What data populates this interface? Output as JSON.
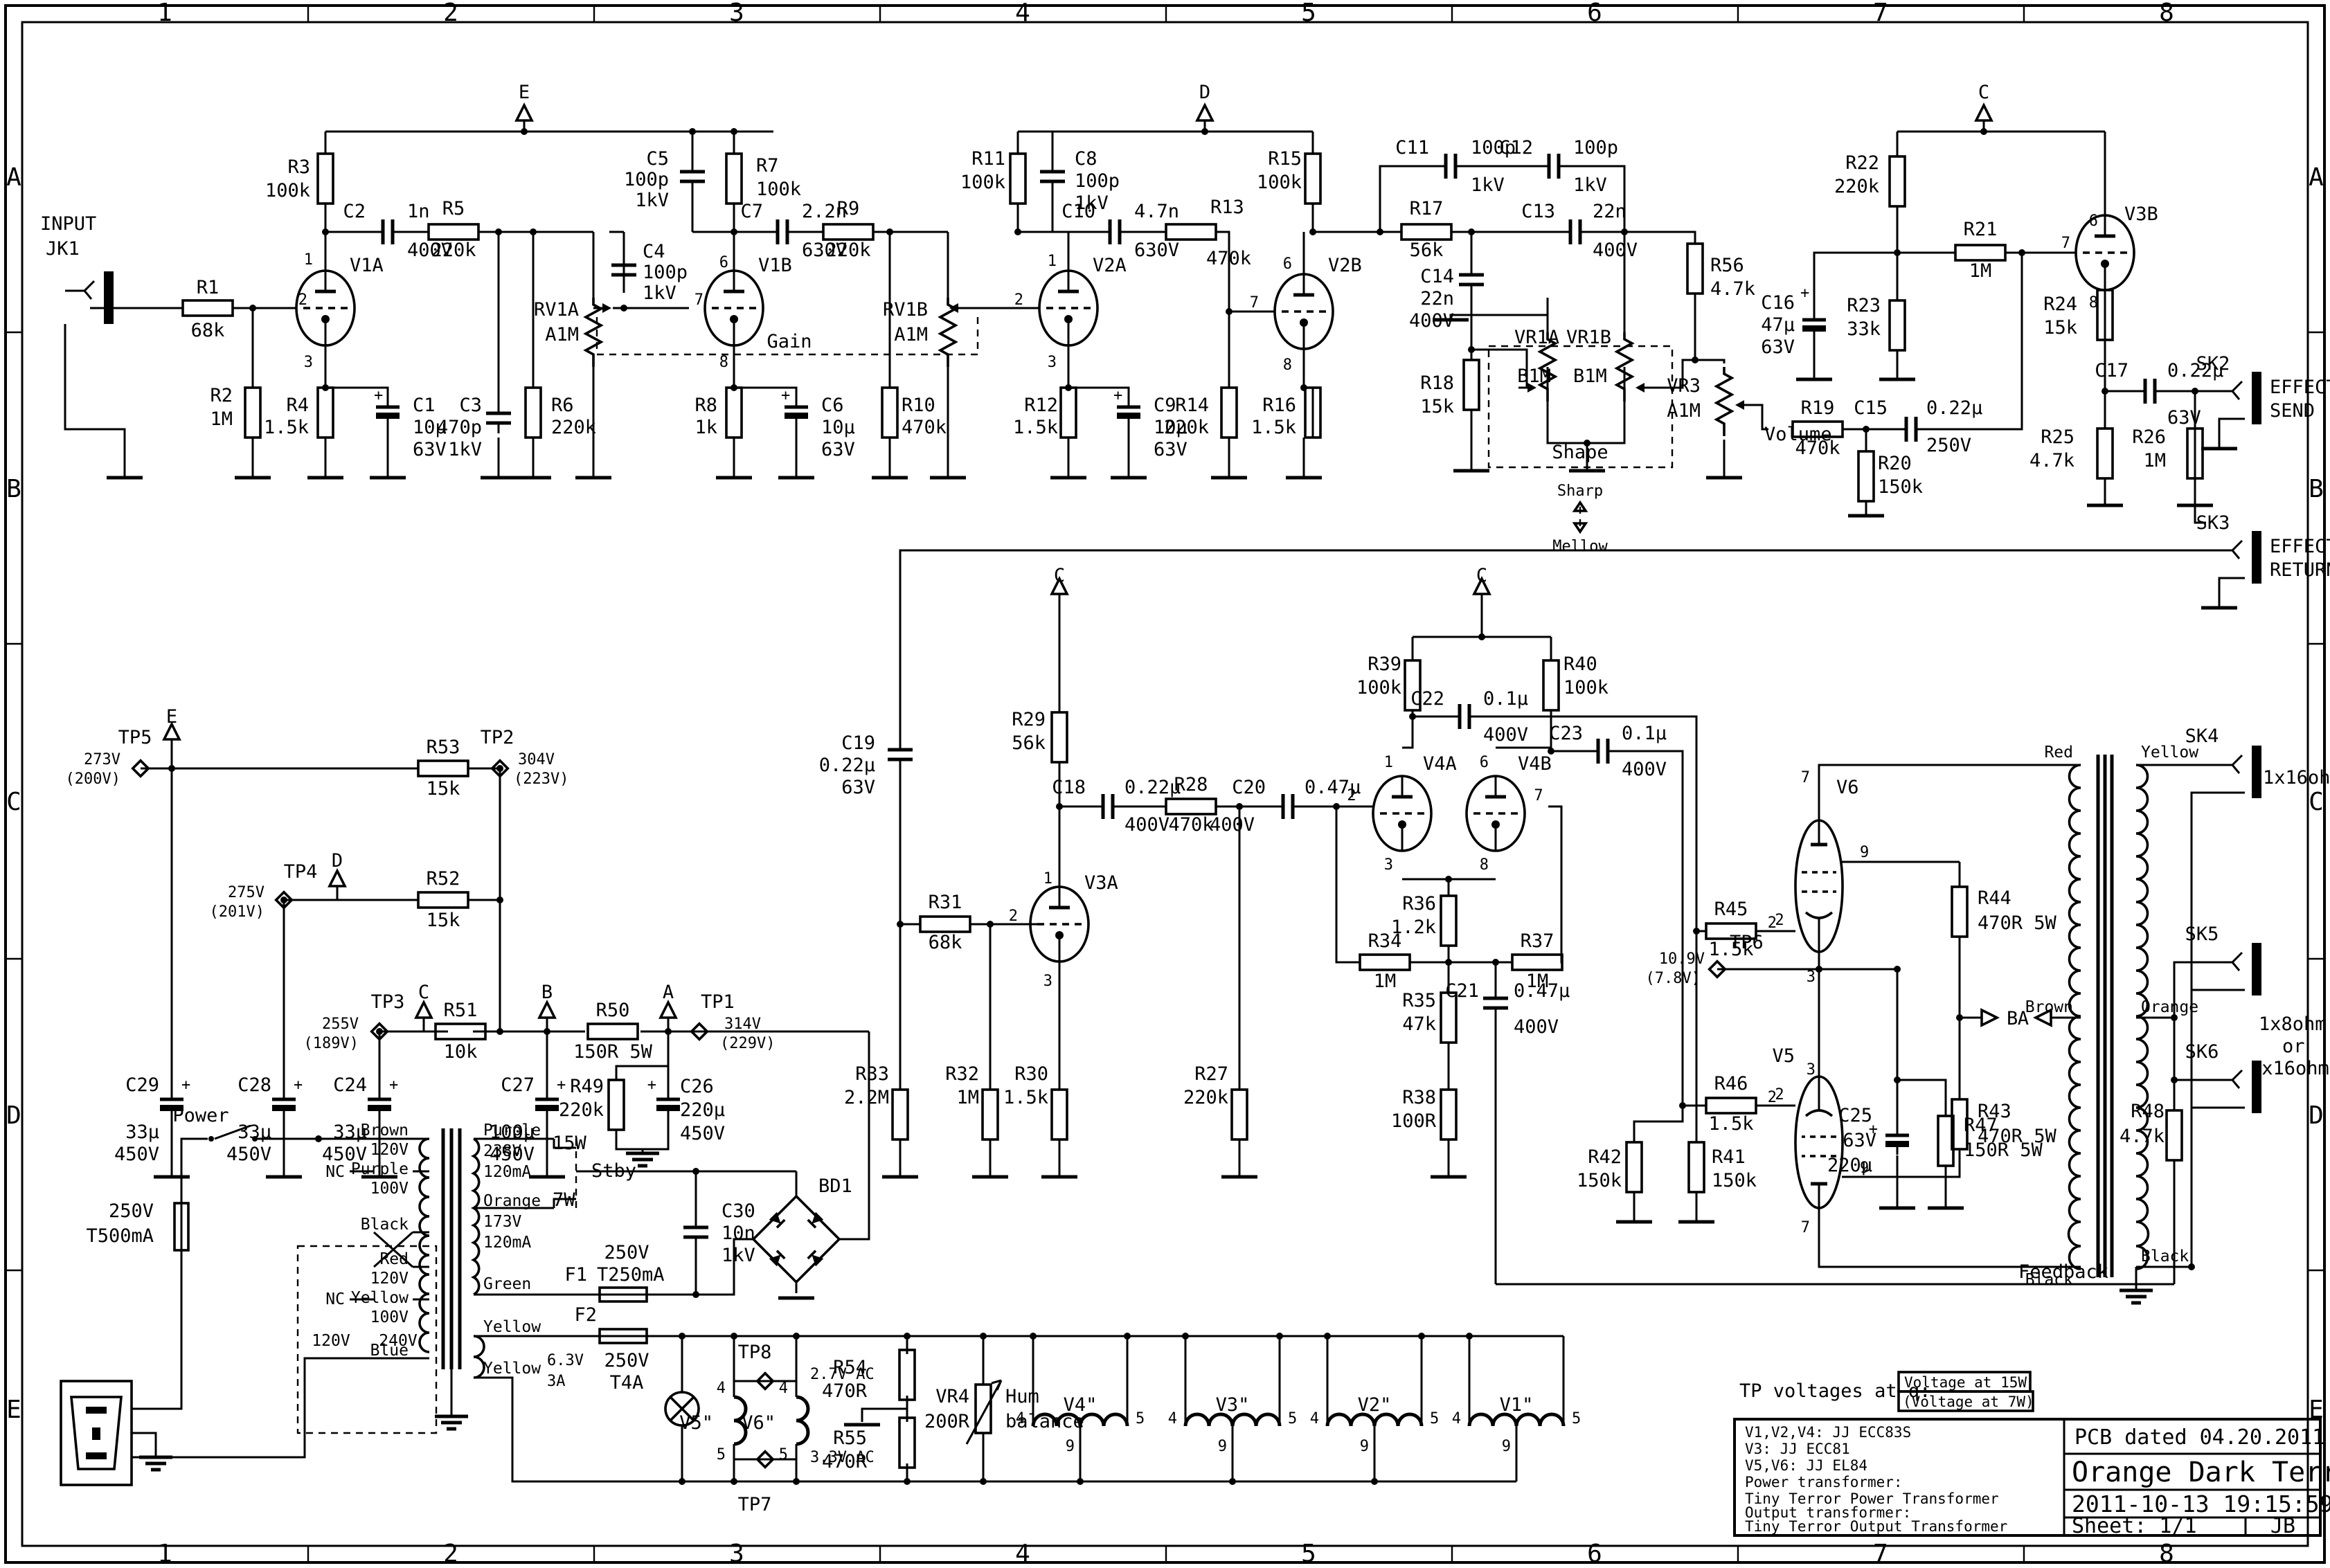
{
  "b": {
    "c": [
      "1",
      "2",
      "3",
      "4",
      "5",
      "6",
      "7",
      "8"
    ],
    "r": [
      "A",
      "B",
      "C",
      "D",
      "E"
    ]
  },
  "t": {
    "in1": "INPUT",
    "in2": "JK1",
    "r1": "R1",
    "r1v": "68k",
    "r2": "R2",
    "r2v": "1M",
    "v1a": "V1A",
    "r3": "R3",
    "r3v": "100k",
    "c2": "C2",
    "c2v": "1n",
    "c2u": "400V",
    "r5": "R5",
    "r5v": "220k",
    "c3": "C3",
    "c3v": "470p",
    "c3u": "1kV",
    "r6": "R6",
    "r6v": "220k",
    "r4": "R4",
    "r4v": "1.5k",
    "c1": "C1",
    "c1v": "10µ",
    "c1u": "63V",
    "e": "E",
    "d": "D",
    "cc": "C",
    "bb": "B",
    "aa": "A",
    "plus": "+",
    "rv1a": "RV1A",
    "rv1av": "A1M",
    "rv1b": "RV1B",
    "rv1bv": "A1M",
    "gain": "Gain",
    "c5": "C5",
    "c5v": "100p",
    "c5u": "1kV",
    "r7": "R7",
    "r7v": "100k",
    "c4": "C4",
    "c4v": "100p",
    "c4u": "1kV",
    "v1b": "V1B",
    "c7": "C7",
    "c7v": "2.2n",
    "c7u": "630V",
    "r9": "R9",
    "r9v": "220k",
    "r8": "R8",
    "r8v": "1k",
    "c6": "C6",
    "c6v": "10µ",
    "c6u": "63V",
    "r10": "R10",
    "r10v": "470k",
    "v2a": "V2A",
    "r11": "R11",
    "r11v": "100k",
    "c8": "C8",
    "c8v": "100p",
    "c8u": "1kV",
    "c10": "C10",
    "c10v": "4.7n",
    "c10u": "630V",
    "r12": "R12",
    "r12v": "1.5k",
    "c9": "C9",
    "c9v": "10µ",
    "c9u": "63V",
    "r13": "R13",
    "r13v": "470k",
    "v2b": "V2B",
    "r14": "R14",
    "r14v": "220k",
    "r15": "R15",
    "r15v": "100k",
    "r16": "R16",
    "r16v": "1.5k",
    "c11": "C11",
    "c11v": "100p",
    "c11u": "1kV",
    "c12": "C12",
    "c12v": "100p",
    "c12u": "1kV",
    "r17": "R17",
    "r17v": "56k",
    "c13": "C13",
    "c13v": "22n",
    "c13u": "400V",
    "c14": "C14",
    "c14v": "22n",
    "c14u": "400V",
    "r18": "R18",
    "r18v": "15k",
    "vr1a": "VR1A",
    "vr1b": "VR1B",
    "b1m": "B1M",
    "b1m2": "B1M",
    "shape": "Shape",
    "sharp": "Sharp",
    "mellow": "Mellow",
    "r56": "R56",
    "r56v": "4.7k",
    "vr3": "VR3",
    "vr3v": "A1M",
    "volume": "Volume",
    "r22": "R22",
    "r22v": "220k",
    "r21": "R21",
    "r21v": "1M",
    "r23": "R23",
    "r23v": "33k",
    "c16": "C16",
    "c16v": "47µ",
    "c16u": "63V",
    "r19": "R19",
    "r19v": "470k",
    "c15": "C15",
    "c15v": "0.22µ",
    "c15u": "250V",
    "r20": "R20",
    "r20v": "150k",
    "v3b": "V3B",
    "r24": "R24",
    "r24v": "15k",
    "c17": "C17",
    "c17v": "0.22µ",
    "c17u": "63V",
    "r25": "R25",
    "r25v": "4.7k",
    "r26": "R26",
    "r26v": "1M",
    "sk2": "SK2",
    "fx1a": "EFFECT",
    "fx1b": "SEND",
    "sk3": "SK3",
    "fx2a": "EFFECT",
    "fx2b": "RETURN",
    "c19": "C19",
    "c19v": "0.22µ",
    "c19u": "63V",
    "r29": "R29",
    "r29v": "56k",
    "v3a": "V3A",
    "r31": "R31",
    "r31v": "68k",
    "c18": "C18",
    "c18v": "0.22µ",
    "c18u": "400V",
    "r28": "R28",
    "r28v": "470k",
    "c20": "C20",
    "c20v": "0.47µ",
    "c20u": "400V",
    "r33": "R33",
    "r33v": "2.2M",
    "r32": "R32",
    "r32v": "1M",
    "r30": "R30",
    "r30v": "1.5k",
    "r27": "R27",
    "r27v": "220k",
    "r39": "R39",
    "r39v": "100k",
    "r40": "R40",
    "r40v": "100k",
    "c22": "C22",
    "c22v": "0.1µ",
    "c22u": "400V",
    "c23": "C23",
    "c23v": "0.1µ",
    "c23u": "400V",
    "v4a": "V4A",
    "v4b": "V4B",
    "r36": "R36",
    "r36v": "1.2k",
    "r34": "R34",
    "r34v": "1M",
    "r37": "R37",
    "r37v": "1M",
    "r35": "R35",
    "r35v": "47k",
    "r38": "R38",
    "r38v": "100R",
    "c21": "C21",
    "c21v": "0.47µ",
    "c21u": "400V",
    "r45": "R45",
    "r45v": "1.5k",
    "r46": "R46",
    "r46v": "1.5k",
    "r41": "R41",
    "r41v": "150k",
    "r42": "R42",
    "r42v": "150k",
    "tp6": "TP6",
    "tp6a": "10.9V",
    "tp6b": "(7.8V)",
    "c25": "C25",
    "c25u": "63V",
    "c25v": "220µ",
    "r47": "R47",
    "r47v": "150R 5W",
    "v6": "V6",
    "v5": "V5",
    "r44": "R44",
    "r44v": "470R 5W",
    "r43": "R43",
    "r43v": "470R 5W",
    "red": "Red",
    "yellow": "Yellow",
    "brown": "Brown",
    "orange": "Orange",
    "black": "Black",
    "black2": "Black",
    "sk4": "SK4",
    "o16": "1x16ohm",
    "sk5": "SK5",
    "sk6": "SK6",
    "o8": "1x8ohm",
    "or_": "or",
    "o216": "2x16ohm",
    "r48": "R48",
    "r48v": "4.7k",
    "fb": "Feedback",
    "tp5": "TP5",
    "tp5a": "273V",
    "tp5b": "(200V)",
    "r53": "R53",
    "r53v": "15k",
    "tp2": "TP2",
    "tp2a": "304V",
    "tp2b": "(223V)",
    "tp4": "TP4",
    "tp4a": "275V",
    "tp4b": "(201V)",
    "r52": "R52",
    "r52v": "15k",
    "tp3": "TP3",
    "tp3a": "255V",
    "tp3b": "(189V)",
    "r51": "R51",
    "r51v": "10k",
    "r50": "R50",
    "r50v": "150R 5W",
    "tp1": "TP1",
    "tp1a": "314V",
    "tp1b": "(229V)",
    "c29": "C29",
    "c29v": "33µ",
    "c29u": "450V",
    "c28": "C28",
    "c28v": "33µ",
    "c28u": "450V",
    "c24": "C24",
    "c24v": "33µ",
    "c24u": "450V",
    "c27": "C27",
    "c27v": "100µ",
    "c27u": "450V",
    "r49": "R49",
    "r49v": "220k",
    "c26": "C26",
    "c26v": "220µ",
    "c26u": "450V",
    "power": "Power",
    "fmv": "250V",
    "fma": "T500mA",
    "v120": "120V",
    "v240": "240V",
    "pbrown": "Brown",
    "p120a": "120V",
    "nc1": "NC",
    "ppurple": "Purple",
    "p100a": "100V",
    "pblack": "Black",
    "pred": "Red",
    "p120b": "120V",
    "nc2": "NC",
    "pyellow": "Yellow",
    "p100b": "100V",
    "pblue": "Blue",
    "spurple": "Purple",
    "s238": "238V",
    "s120ma": "120mA",
    "w15": "15W",
    "stby": "Stby",
    "w7": "7W",
    "sorange": "Orange",
    "s173": "173V",
    "s120mb": "120mA",
    "sgreen": "Green",
    "f1": "F1",
    "f1v": "250V",
    "f1a": "T250mA",
    "c30": "C30",
    "c30v": "10n",
    "c30u": "1kV",
    "bd1": "BD1",
    "syel1": "Yellow",
    "syel2": "Yellow",
    "s63": "6.3V",
    "s3a": "3A",
    "f2": "F2",
    "f2v": "250V",
    "f2a": "T4A",
    "v5h": "V5\"",
    "v6h": "V6\"",
    "v4h": "V4\"",
    "v3h": "V3\"",
    "v2h": "V2\"",
    "v1h": "V1\"",
    "tp8": "TP8",
    "tp8v": "2.7V AC",
    "tp7": "TP7",
    "tp7v": "3.3V AC",
    "r54": "R54",
    "r54v": "470R",
    "r55": "R55",
    "r55v": "470R",
    "vr4": "VR4",
    "vr4v": "200R",
    "hum1": "Hum",
    "hum2": "balance",
    "n1": "1",
    "n2": "2",
    "n3": "3",
    "n4": "4",
    "n5": "5",
    "n6": "6",
    "n7": "7",
    "n8": "8",
    "n9": "9"
  },
  "note": {
    "lead": "TP voltages at q:",
    "b15": "Voltage at 15W",
    "b7": "(Voltage at 7W)"
  },
  "tb": {
    "l1": "V1,V2,V4: JJ ECC83S",
    "l2": "V3: JJ ECC81",
    "l3": "V5,V6: JJ EL84",
    "l4": "Power transformer:",
    "l5": "Tiny Terror Power Transformer",
    "l6": "Output transformer:",
    "l7": "Tiny Terror Output Transformer",
    "pcb": "PCB dated 04.20.2011",
    "model": "Orange Dark Terror",
    "dt": "2011-10-13 19:15:59",
    "sheet": "Sheet: 1/1",
    "by": "JB"
  }
}
